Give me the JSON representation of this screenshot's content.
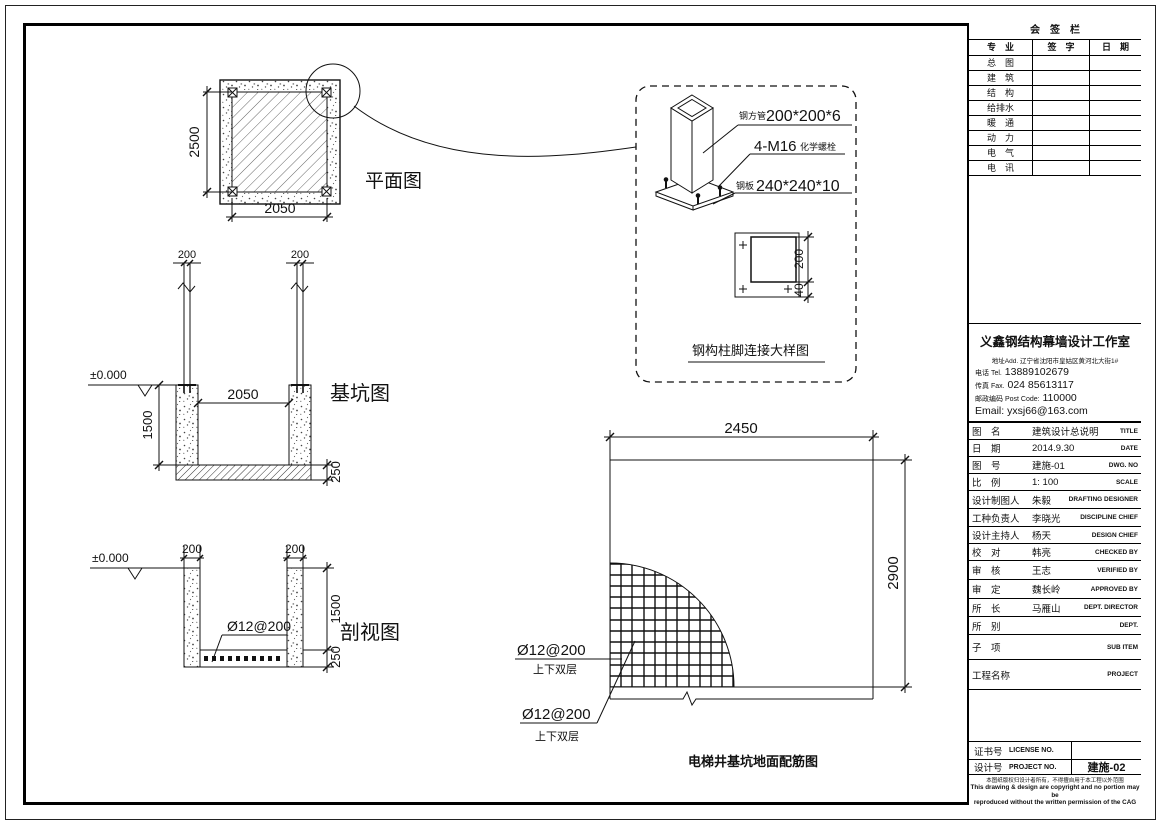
{
  "sign_table": {
    "title": "会　签　栏",
    "col_specialty": "专　业",
    "col_signature": "签　字",
    "col_date": "日　期",
    "rows": [
      "总　图",
      "建　筑",
      "结　构",
      "给排水",
      "暖　通",
      "动　力",
      "电　气",
      "电　讯"
    ]
  },
  "company": {
    "name": "义鑫钢结构幕墙设计工作室",
    "address": "地址Add. 辽宁省沈阳市皇姑区黄河北大街1#",
    "tel_cn": "电话 Tel.",
    "tel": "13889102679",
    "fax_cn": "传真 Fax.",
    "fax": "024 85613117",
    "post_cn": "邮政编码 Post Code:",
    "post": "110000",
    "email_label": "Email:",
    "email": "yxsj66@163.com"
  },
  "fields": [
    {
      "label": "图　名",
      "value": "建筑设计总说明",
      "en": "TITLE"
    },
    {
      "label": "日　期",
      "value": "2014.9.30",
      "en": "DATE"
    },
    {
      "label": "图　号",
      "value": "建施-01",
      "en": "DWG. NO"
    },
    {
      "label": "比　例",
      "value": "1: 100",
      "en": "SCALE"
    },
    {
      "label": "设计制图人",
      "value": "朱毅",
      "en": "DRAFTING DESIGNER"
    },
    {
      "label": "工种负责人",
      "value": "李晓光",
      "en": "DISCIPLINE CHIEF"
    },
    {
      "label": "设计主持人",
      "value": "杨天",
      "en": "DESIGN CHIEF"
    },
    {
      "label": "校　对",
      "value": "韩亮",
      "en": "CHECKED BY"
    },
    {
      "label": "审　核",
      "value": "王志",
      "en": "VERIFIED BY"
    },
    {
      "label": "审　定",
      "value": "魏长岭",
      "en": "APPROVED BY"
    },
    {
      "label": "所　长",
      "value": "马雁山",
      "en": "DEPT. DIRECTOR"
    },
    {
      "label": "所　别",
      "value": "",
      "en": "DEPT."
    },
    {
      "label": "子　项",
      "value": "",
      "en": "SUB ITEM"
    },
    {
      "label": "工程名称",
      "value": "",
      "en": "PROJECT"
    }
  ],
  "footer": {
    "license_label": "证书号",
    "license_en": "LICENSE NO.",
    "license_value": "",
    "design_label": "设计号",
    "design_en": "PROJECT NO.",
    "design_value": "建施-02",
    "copyright_cn": "本图纸版权归设计者所有，不得擅自用于本工程以外范围",
    "copyright_en1": "This drawing & design are copyright and no portion may be",
    "copyright_en2": "reproduced without the written permission of the CAG"
  },
  "plan_view": {
    "title": "平面图",
    "dim_height": "2500",
    "dim_width": "2050"
  },
  "pit_view": {
    "title": "基坑图",
    "level": "±0.000",
    "dim_col_left": "200",
    "dim_col_right": "200",
    "dim_inner": "2050",
    "dim_depth": "1500",
    "dim_slab": "250"
  },
  "section_view": {
    "title": "剖视图",
    "level": "±0.000",
    "dim_wall_left": "200",
    "dim_wall_right": "200",
    "rebar": "Ø12@200",
    "dim_depth": "1500",
    "dim_slab": "250"
  },
  "detail_view": {
    "title": "钢构柱脚连接大样图",
    "tube_cn": "钢方管",
    "tube_num": "200*200*6",
    "bolt_num": "4-M16",
    "bolt_cn": "化学螺栓",
    "plate_cn": "钢板",
    "plate_num": "240*240*10",
    "dim_inner": "200",
    "dim_edge": "40"
  },
  "rebar_plan": {
    "title": "电梯井基坑地面配筋图",
    "dim_width": "2450",
    "dim_height": "2900",
    "rebar1": "Ø12@200",
    "rebar1_sub": "上下双层",
    "rebar2": "Ø12@200",
    "rebar2_sub": "上下双层"
  }
}
